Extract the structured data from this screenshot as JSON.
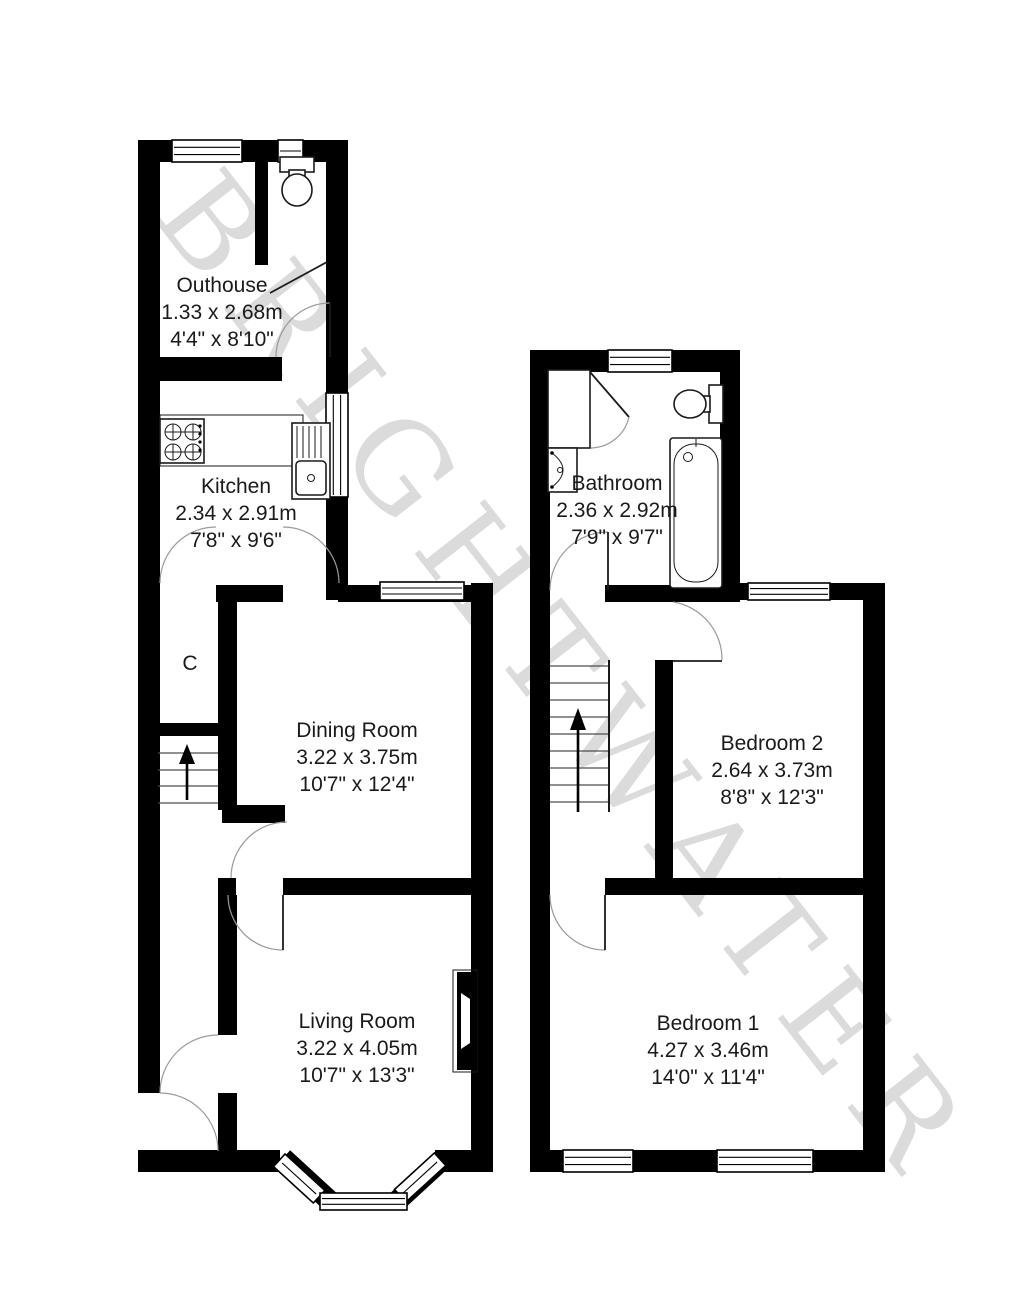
{
  "watermark": "BRIGHTWATER",
  "colors": {
    "wall": "#000000",
    "room_fill": "#ffffff",
    "door_arc": "#9a9a9a",
    "text": "#1a1a1a",
    "watermark": "rgba(0,0,0,0.14)"
  },
  "ground_floor": {
    "cupboard_label": "C",
    "stairs_direction": "up",
    "fixtures": [
      "toilet",
      "hob",
      "kitchen-sink",
      "fireplace",
      "bay-window",
      "stairs"
    ],
    "rooms": {
      "outhouse": {
        "name": "Outhouse",
        "metric": "1.33 x 2.68m",
        "imperial": "4'4\" x 8'10\""
      },
      "kitchen": {
        "name": "Kitchen",
        "metric": "2.34 x 2.91m",
        "imperial": "7'8\" x 9'6\""
      },
      "dining": {
        "name": "Dining Room",
        "metric": "3.22 x 3.75m",
        "imperial": "10'7\" x 12'4\""
      },
      "living": {
        "name": "Living Room",
        "metric": "3.22 x 4.05m",
        "imperial": "10'7\" x 13'3\""
      }
    }
  },
  "first_floor": {
    "stairs_direction": "up",
    "fixtures": [
      "shower",
      "toilet",
      "wash-basin",
      "bath",
      "stairs"
    ],
    "rooms": {
      "bathroom": {
        "name": "Bathroom",
        "metric": "2.36 x 2.92m",
        "imperial": "7'9\" x 9'7\""
      },
      "bedroom2": {
        "name": "Bedroom 2",
        "metric": "2.64 x 3.73m",
        "imperial": "8'8\" x 12'3\""
      },
      "bedroom1": {
        "name": "Bedroom 1",
        "metric": "4.27 x 3.46m",
        "imperial": "14'0\" x 11'4\""
      }
    }
  }
}
